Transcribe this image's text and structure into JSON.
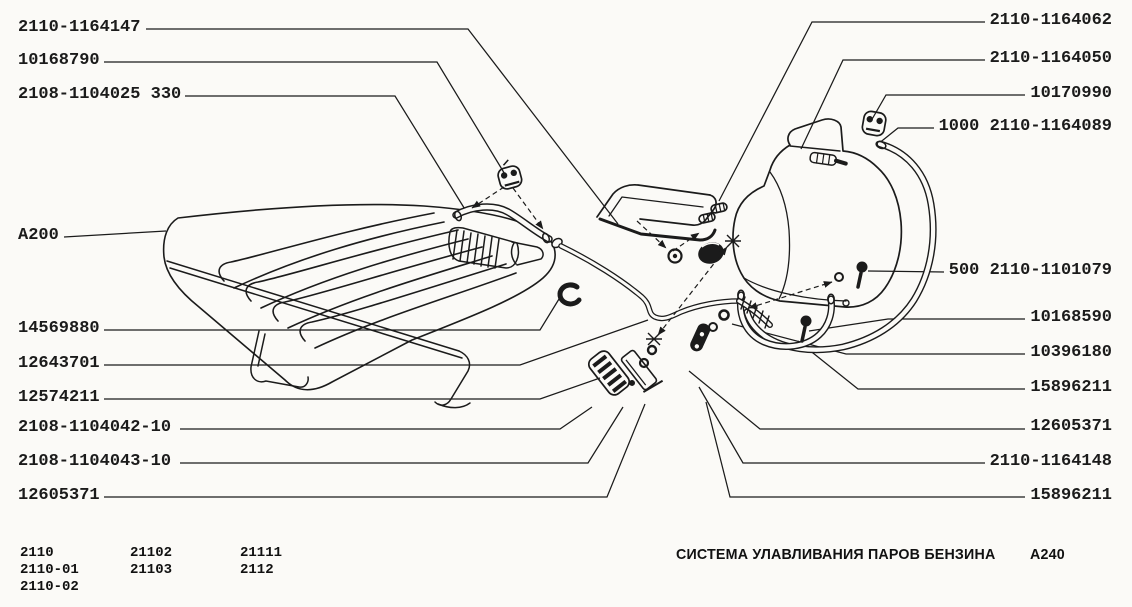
{
  "colors": {
    "ink": "#1b1b1b",
    "paper": "#FBFAF7"
  },
  "labels": {
    "left": [
      {
        "text": "2110-1164147"
      },
      {
        "text": "10168790"
      },
      {
        "text": "2108-1104025 330"
      },
      {
        "text": "A200"
      },
      {
        "text": "14569880"
      },
      {
        "text": "12643701"
      },
      {
        "text": "12574211"
      },
      {
        "text": "2108-1104042-10"
      },
      {
        "text": "2108-1104043-10"
      },
      {
        "text": "12605371"
      }
    ],
    "right": [
      {
        "text": "2110-1164062"
      },
      {
        "text": "2110-1164050"
      },
      {
        "text": "10170990"
      },
      {
        "text": "1000 2110-1164089"
      },
      {
        "text": "500 2110-1101079"
      },
      {
        "text": "10168590"
      },
      {
        "text": "10396180"
      },
      {
        "text": "15896211"
      },
      {
        "text": "12605371"
      },
      {
        "text": "2110-1164148"
      },
      {
        "text": "15896211"
      }
    ]
  },
  "footer": {
    "models": [
      [
        "2110",
        "2110-01",
        "2110-02"
      ],
      [
        "21102",
        "21103"
      ],
      [
        "21111",
        "2112"
      ]
    ],
    "title": "СИСТЕМА УЛАВЛИВАНИЯ ПАРОВ БЕНЗИНА",
    "code": "A240"
  }
}
